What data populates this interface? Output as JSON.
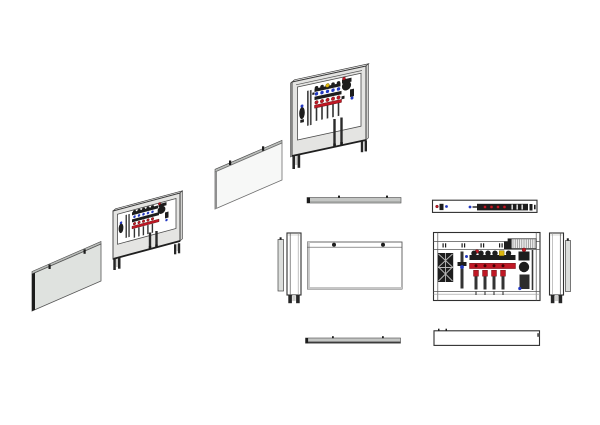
{
  "page": {
    "background": "#ffffff"
  },
  "drawing": {
    "type": "multi-view-technical-drawing",
    "subject": "manifold-cabinet",
    "views": [
      {
        "id": "iso-exploded-small",
        "kind": "isometric-exploded",
        "parts": [
          "cover-panel",
          "cabinet-frame",
          "manifold-assembly",
          "feet"
        ]
      },
      {
        "id": "iso-exploded-large",
        "kind": "isometric-exploded",
        "parts": [
          "cover-panel",
          "cabinet-frame",
          "manifold-assembly",
          "feet"
        ]
      },
      {
        "id": "top-cover",
        "kind": "top-view",
        "parts": [
          "cover-panel",
          "knobs"
        ]
      },
      {
        "id": "top-cabinet",
        "kind": "top-view",
        "parts": [
          "cabinet-shell",
          "manifold-components"
        ]
      },
      {
        "id": "side-left",
        "kind": "side-view",
        "parts": [
          "cover-edge",
          "cabinet-side",
          "feet"
        ]
      },
      {
        "id": "front-cover",
        "kind": "front-view",
        "parts": [
          "cover-panel",
          "screws"
        ],
        "screw_count": 2
      },
      {
        "id": "front-cabinet",
        "kind": "front-view",
        "parts": [
          "frame",
          "rail-slots",
          "din-rail",
          "lattice-bracket",
          "manifold",
          "valve-actuators",
          "pump-group"
        ]
      },
      {
        "id": "side-right",
        "kind": "side-view",
        "parts": [
          "cabinet-side",
          "cover-edge",
          "feet"
        ]
      },
      {
        "id": "bottom-cover",
        "kind": "bottom-view",
        "parts": [
          "cover-panel"
        ]
      },
      {
        "id": "bottom-cabinet",
        "kind": "bottom-view",
        "parts": [
          "cabinet-shell"
        ]
      }
    ]
  },
  "colors": {
    "background": "#ffffff",
    "outline": "#3c3c3c",
    "frame_fill": "#e4e4e2",
    "frame_top": "#f6f6f5",
    "frame_side": "#d2d2d0",
    "cover_light": "#f7f8f7",
    "cover_gray": "#dfe2df",
    "cover_band": "#b9bcb9",
    "edge_dark": "#1c1c1c",
    "component_dark": "#1d1d1d",
    "accent_red": "#c01825",
    "accent_blue": "#2238c0",
    "accent_yellow": "#ddb70f",
    "hatch_gray": "#777777",
    "foot_dark": "#262626"
  }
}
